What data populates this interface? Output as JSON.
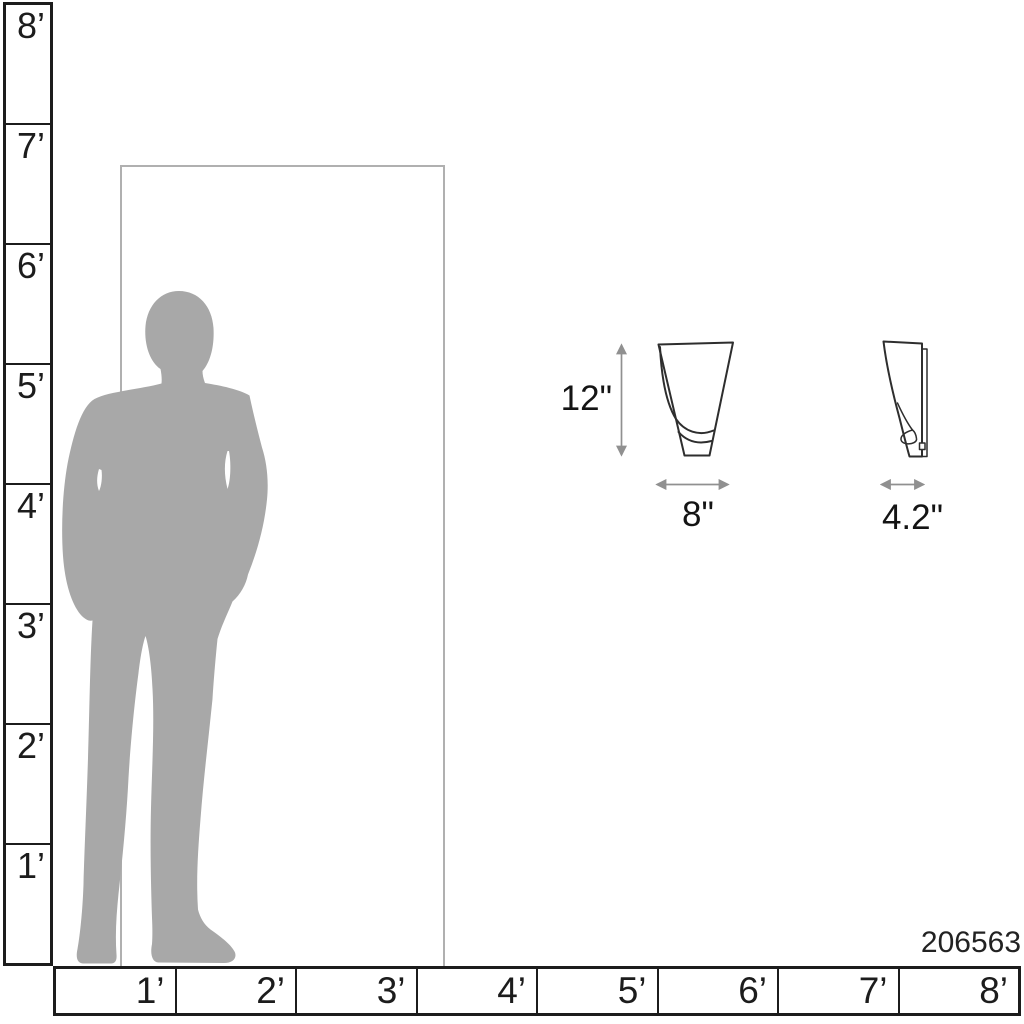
{
  "product": {
    "sku": "206563",
    "height_label": "12\"",
    "width_label": "8\"",
    "depth_label": "4.2\""
  },
  "scale": {
    "vertical_ruler": {
      "unit": "feet",
      "labels": [
        "8’",
        "7’",
        "6’",
        "5’",
        "4’",
        "3’",
        "2’",
        "1’"
      ]
    },
    "horizontal_ruler": {
      "unit": "feet",
      "labels": [
        "1’",
        "2’",
        "3’",
        "4’",
        "5’",
        "6’",
        "7’",
        "8’"
      ]
    }
  },
  "reference_objects": {
    "person": "human-silhouette-icon",
    "door": "door-outline",
    "fixture_front": "sconce-front-view-drawing",
    "fixture_side": "sconce-side-view-drawing"
  },
  "colors": {
    "background": "#ffffff",
    "silhouette": "#a8a8a8",
    "door_outline": "#b0b0b0",
    "line": "#1c1c1c",
    "drawing_line": "#2e2e2e",
    "arrow": "#909090"
  }
}
